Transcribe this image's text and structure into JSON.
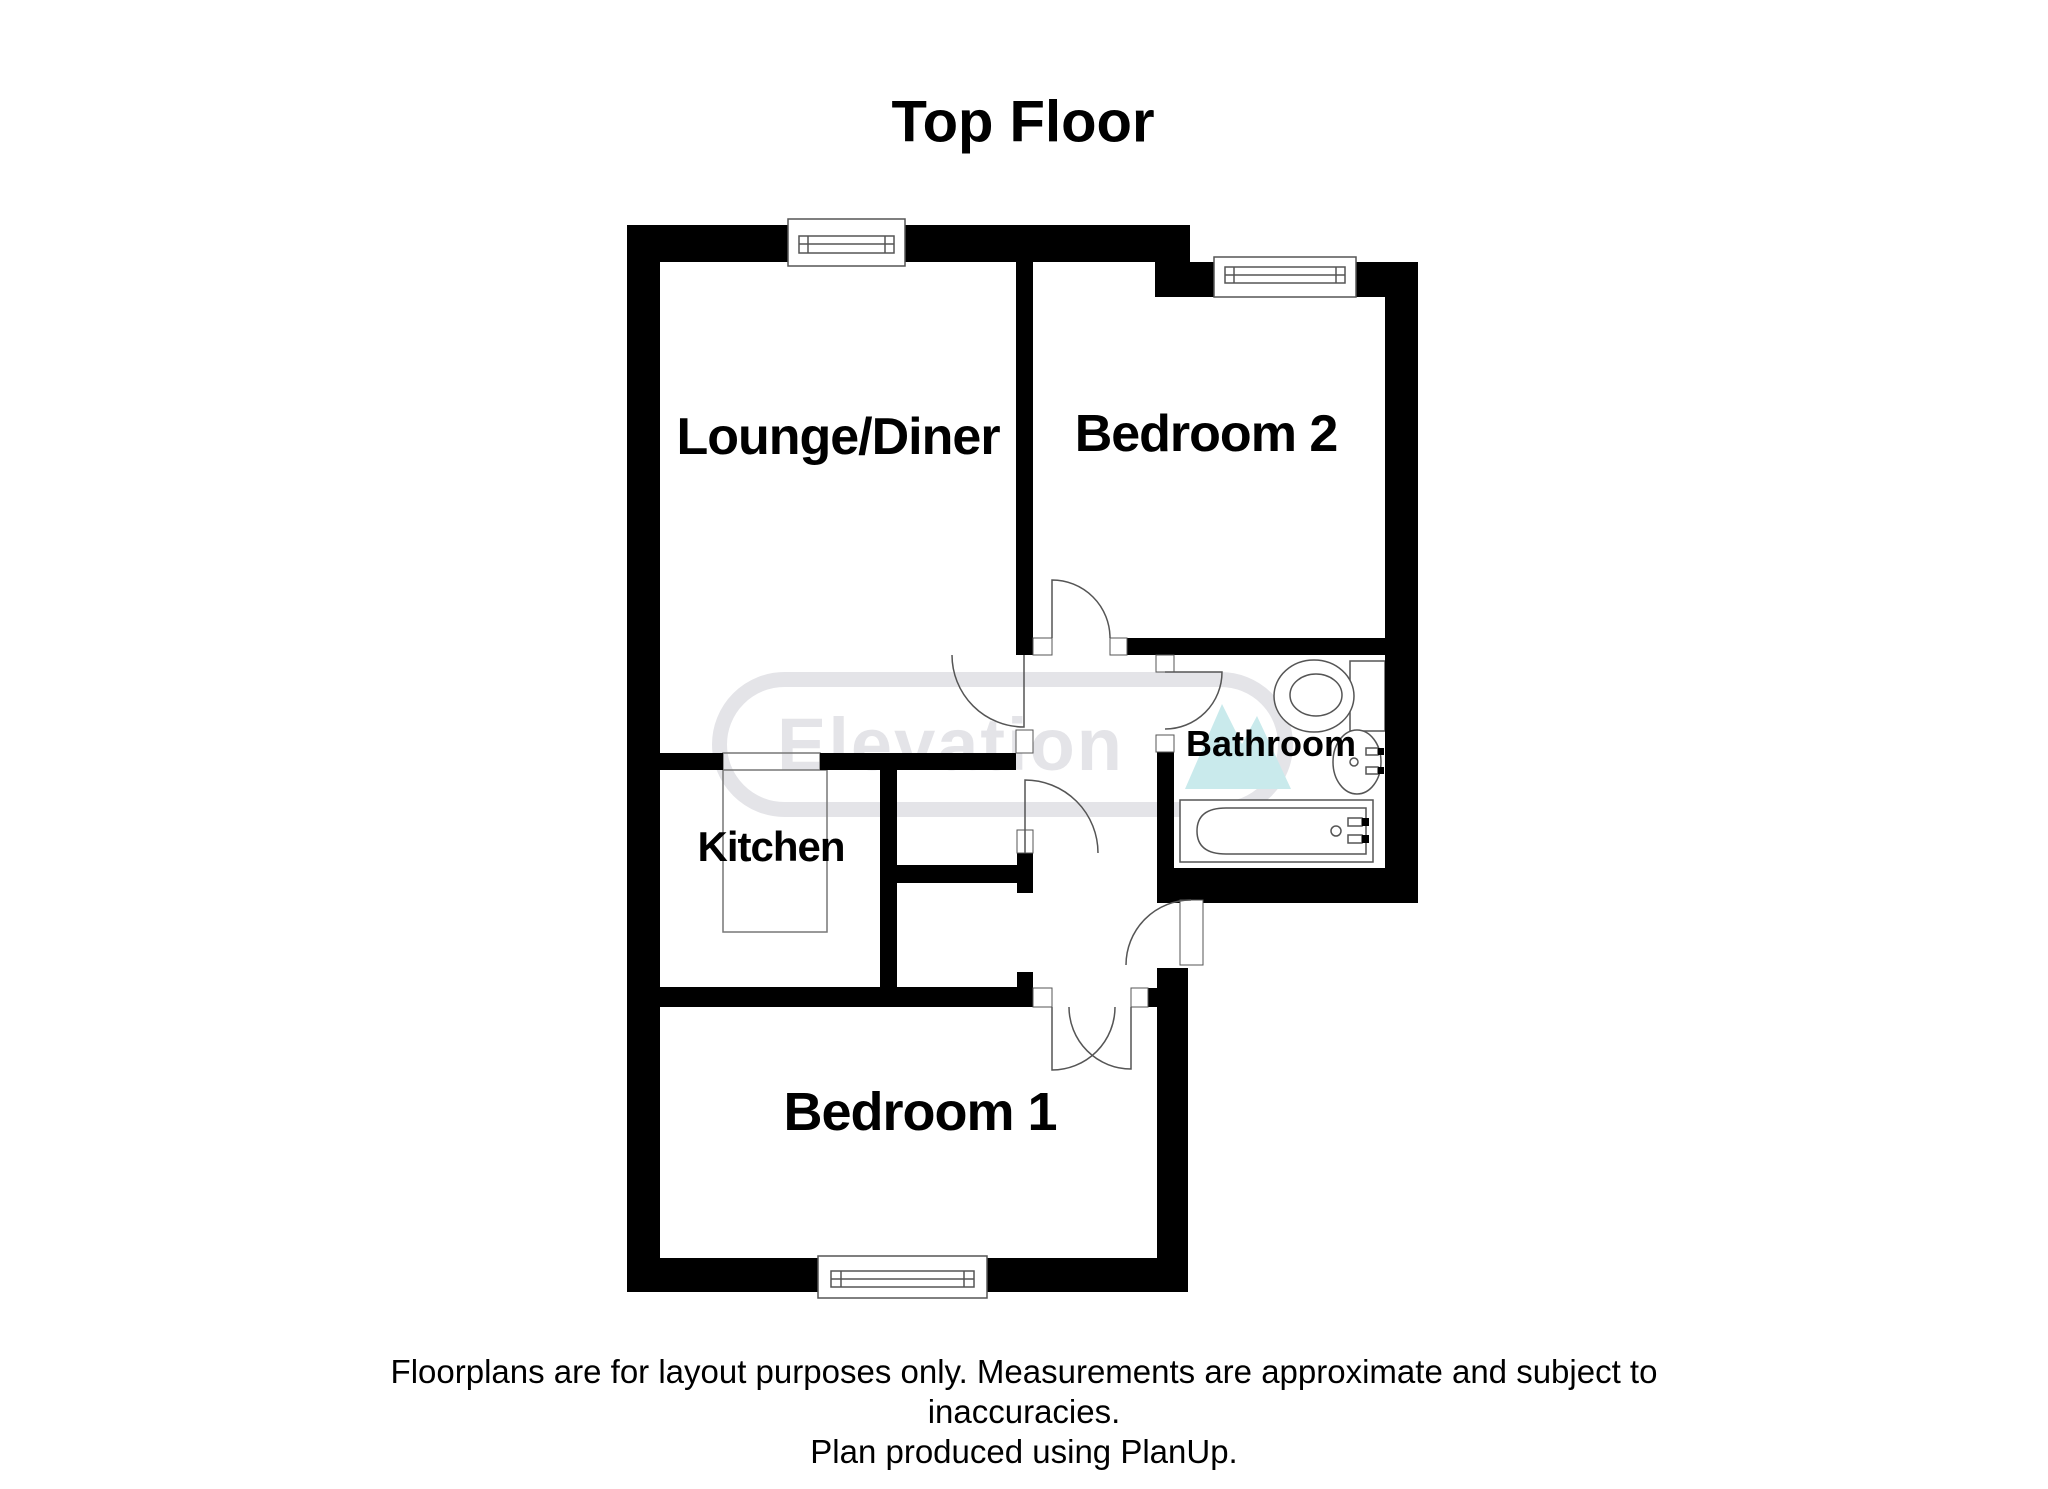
{
  "title": "Top Floor",
  "rooms": {
    "lounge": {
      "label": "Lounge/Diner"
    },
    "bedroom2": {
      "label": "Bedroom 2"
    },
    "bathroom": {
      "label": "Bathroom"
    },
    "kitchen": {
      "label": "Kitchen"
    },
    "bedroom1": {
      "label": "Bedroom 1"
    }
  },
  "watermark": {
    "text": "Elevation",
    "icon": "mountain-icon",
    "text_color": "#e4e4e8",
    "border_color": "#e4e4e8",
    "icon_color": "#c9eaec"
  },
  "disclaimer": {
    "line1": "Floorplans are for layout purposes only. Measurements are approximate and subject to",
    "line2": "inaccuracies.",
    "line3": "Plan produced using PlanUp."
  },
  "colors": {
    "wall": "#000000",
    "background": "#ffffff",
    "fixture_outline": "#555555"
  }
}
